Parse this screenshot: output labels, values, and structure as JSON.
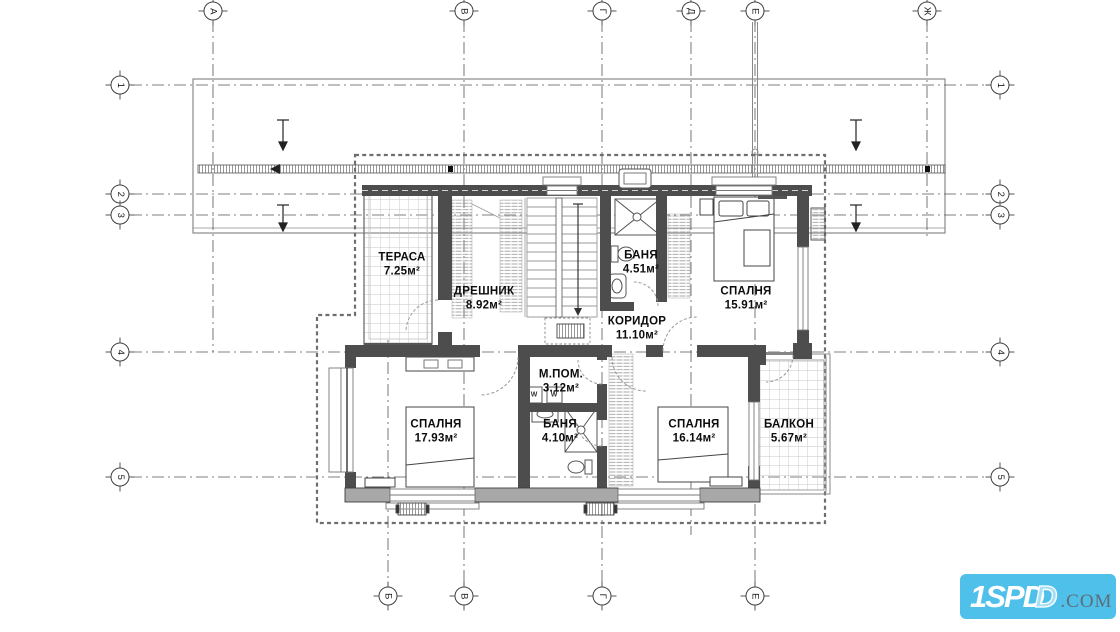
{
  "axes": {
    "top": [
      "А",
      "В",
      "Г",
      "Д",
      "Е",
      "Ж"
    ],
    "bottom": [
      "Б",
      "В",
      "Г",
      "Е"
    ],
    "left": [
      "1",
      "2",
      "3",
      "4",
      "5"
    ],
    "right": [
      "1",
      "2",
      "3",
      "4",
      "5"
    ]
  },
  "rooms": {
    "terrace": {
      "name": "ТЕРАСА",
      "area": "7.25м²"
    },
    "closet": {
      "name": "ДРЕШНИК",
      "area": "8.92м²"
    },
    "bath_upper": {
      "name": "БАНЯ",
      "area": "4.51м²"
    },
    "bedroom_right_top": {
      "name": "СПАЛНЯ",
      "area": "15.91м²"
    },
    "corridor": {
      "name": "КОРИДОР",
      "area": "11.10м²"
    },
    "utility": {
      "name": "М.ПОМ.",
      "area": "3.12м²"
    },
    "bedroom_left": {
      "name": "СПАЛНЯ",
      "area": "17.93м²"
    },
    "bath_lower": {
      "name": "БАНЯ",
      "area": "4.10м²"
    },
    "bedroom_right_bottom": {
      "name": "СПАЛНЯ",
      "area": "16.14м²"
    },
    "balcony": {
      "name": "БАЛКОН",
      "area": "5.67м²"
    }
  },
  "fixtures": {
    "washer_label": "W"
  },
  "logo": {
    "main": "1SP",
    "echo_solid": "D",
    "echo_outline": "D",
    "suffix": ".COM",
    "bg_color": "#4fc0ea",
    "suffix_color": "#5d6e7a"
  },
  "colors": {
    "wall": "#4d4d4d",
    "wall_light": "#a8a8a8",
    "line": "#888888",
    "grid": "#555555",
    "text": "#0c0c0c"
  }
}
